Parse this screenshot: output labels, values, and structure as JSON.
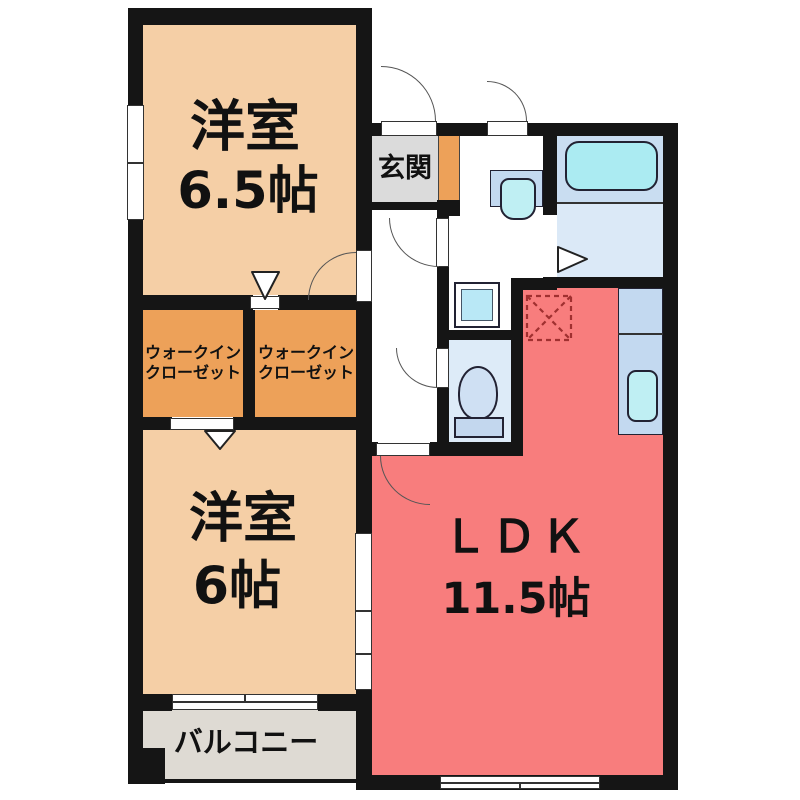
{
  "plan": {
    "type": "apartment-floor-plan",
    "rooms": {
      "bedroom_top": {
        "label": "洋室",
        "size": "6.5帖"
      },
      "entrance": {
        "label": "玄関"
      },
      "wic_left": {
        "line1": "ウォークイン",
        "line2": "クローゼット"
      },
      "wic_right": {
        "line1": "ウォークイン",
        "line2": "クローゼット"
      },
      "bedroom_bottom": {
        "label": "洋室",
        "size": "6帖"
      },
      "ldk": {
        "label": "ＬＤＫ",
        "size": "11.5帖"
      },
      "balcony": {
        "label": "バルコニー"
      }
    },
    "fixtures": [
      "bathtub",
      "washbasin",
      "washing-machine-pan",
      "toilet",
      "kitchen-sink",
      "refrigerator-space"
    ],
    "palette": {
      "wall": "#151515",
      "bedroom_floor": "#F5CFA6",
      "closet_floor": "#EDA159",
      "ldk_floor": "#F87D7D",
      "entrance_floor": "#DBDBDB",
      "balcony_floor": "#DEDAD3",
      "bath_upper": "#C9DDF1",
      "bath_lower": "#DBE9F7",
      "toilet_floor": "#DDEBF8",
      "counter_blue": "#C3D9F0",
      "water_cyan": "#ABEBF2",
      "refrigerator_dash": "#A03030"
    }
  }
}
